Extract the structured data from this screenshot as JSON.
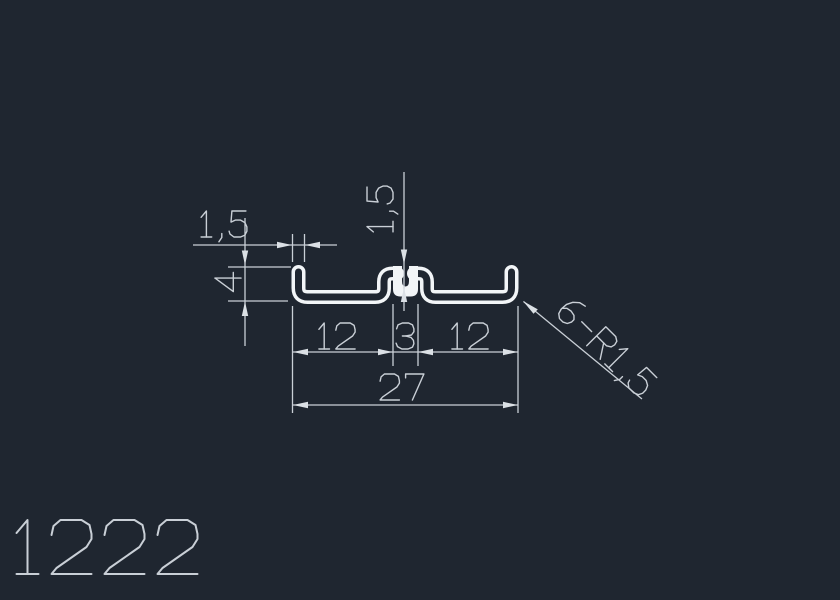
{
  "canvas": {
    "background_color": "#1f2630",
    "profile_line_color": "#f2f5f7",
    "dimension_color": "#c9cfd6"
  },
  "drawing": {
    "part_number": "1222",
    "dimensions": {
      "lip_wall_thickness": "1,5",
      "lip_height": "4",
      "slot_top_width": "1,5",
      "left_span": "12",
      "slot_width": "3",
      "right_span": "12",
      "total_width": "27",
      "radius_note": "6-R1,5"
    }
  }
}
